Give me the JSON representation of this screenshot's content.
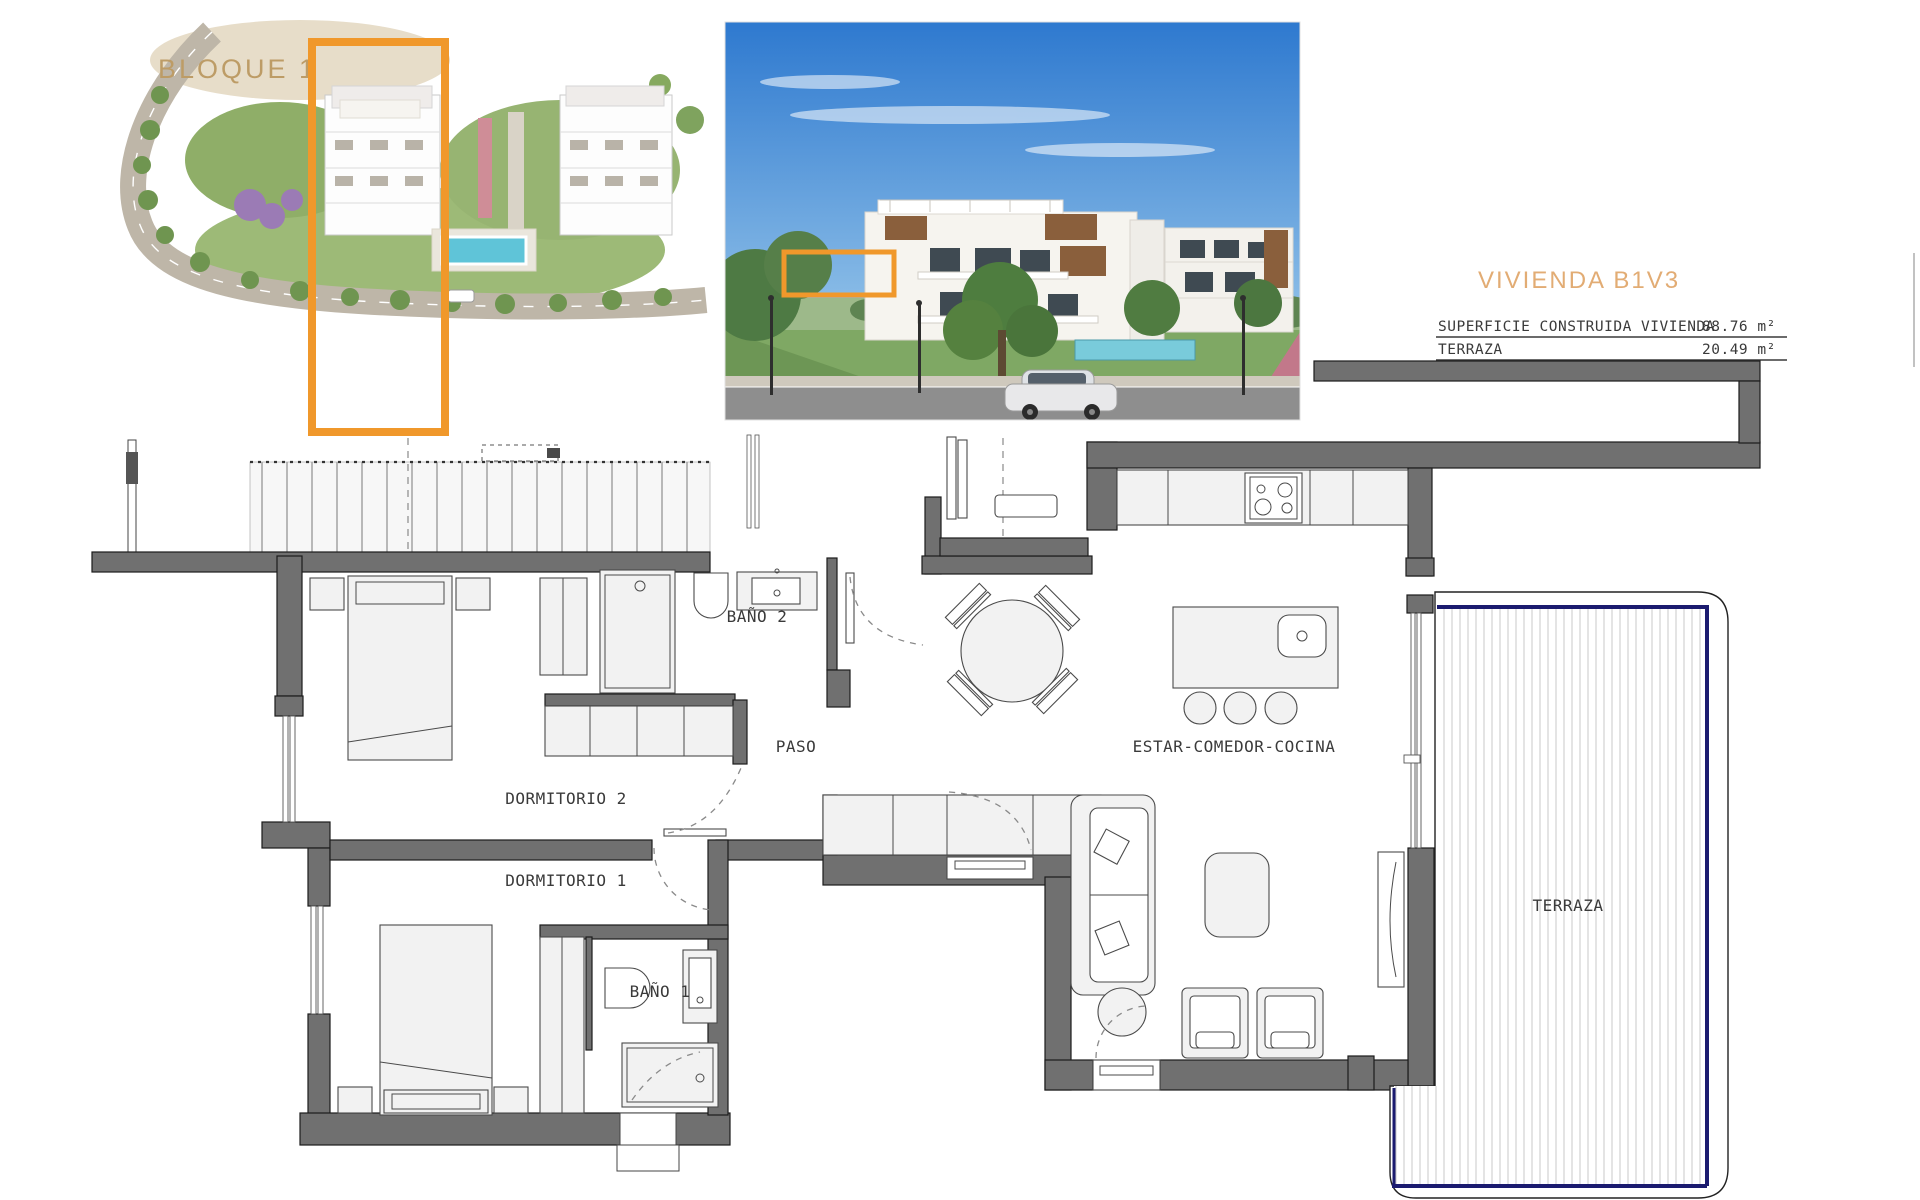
{
  "colors": {
    "accent_orange": "#F0982B",
    "label_tan": "#BD9C66",
    "title_peach": "#E2AC74",
    "wall_gray": "#707070",
    "terrace_navy": "#1B1B6F"
  },
  "aerial_view": {
    "label": "BLOQUE 1"
  },
  "unit_panel": {
    "title": "VIVIENDA B1V3",
    "rows": [
      {
        "label": "SUPERFICIE CONSTRUIDA VIVIENDA",
        "value": "88.76 m²"
      },
      {
        "label": "TERRAZA",
        "value": "20.49 m²"
      }
    ]
  },
  "floorplan": {
    "labels": {
      "bano2": "BAÑO 2",
      "paso": "PASO",
      "dormitorio2": "DORMITORIO 2",
      "dormitorio1": "DORMITORIO 1",
      "bano1": "BAÑO 1",
      "estar": "ESTAR-COMEDOR-COCINA",
      "terraza": "TERRAZA"
    }
  }
}
